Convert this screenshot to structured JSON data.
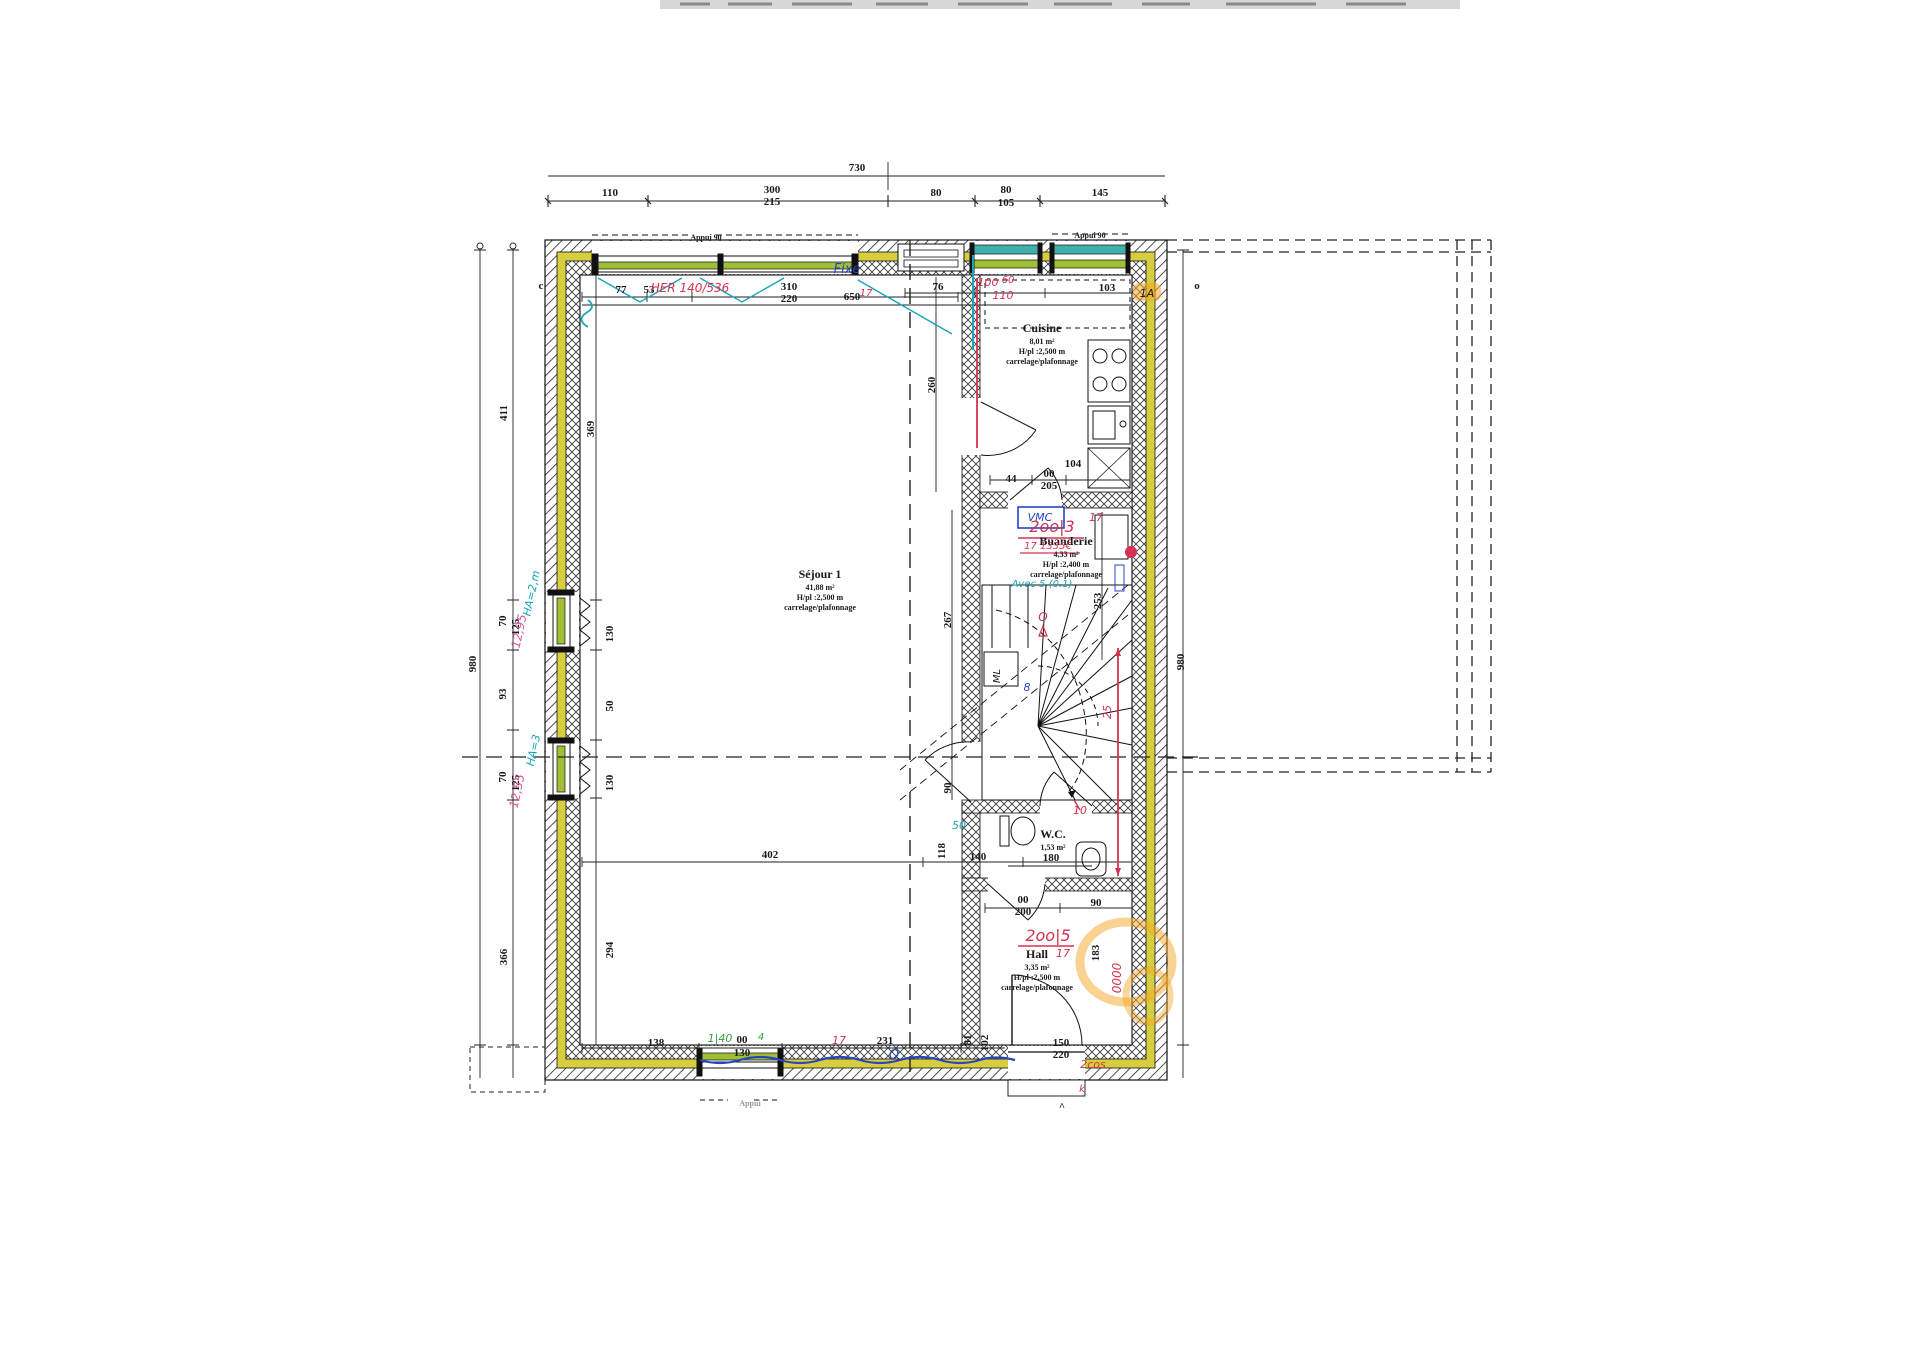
{
  "title": "Plan rez-de-chaussee scanne et annote",
  "rooms": [
    {
      "name": "Séjour 1",
      "area": "41,88 m²",
      "height": "H/pl :2,500 m",
      "finish": "carrelage/plafonnage",
      "x": 820,
      "y": 578
    },
    {
      "name": "Cuisine",
      "area": "8,01 m²",
      "height": "H/pl :2,500 m",
      "finish": "carrelage/plafonnage",
      "x": 1042,
      "y": 332
    },
    {
      "name": "Buanderie",
      "area": "4,33 m²",
      "height": "H/pl :2,400 m",
      "finish": "carrelage/plafonnage",
      "x": 1066,
      "y": 545
    },
    {
      "name": "W.C.",
      "area": "1,53 m²",
      "height": "",
      "finish": "",
      "x": 1053,
      "y": 838
    },
    {
      "name": "Hall",
      "area": "3,35 m²",
      "height": "H/pl :2,500 m",
      "finish": "carrelage/plafonnage",
      "x": 1037,
      "y": 958
    }
  ],
  "dimensions": [
    {
      "t": "730",
      "x": 857,
      "y": 171
    },
    {
      "t": "110",
      "x": 610,
      "y": 196
    },
    {
      "t": "300",
      "x": 772,
      "y": 193
    },
    {
      "t": "215",
      "x": 772,
      "y": 205
    },
    {
      "t": "80",
      "x": 936,
      "y": 196
    },
    {
      "t": "80",
      "x": 1006,
      "y": 193
    },
    {
      "t": "105",
      "x": 1006,
      "y": 206
    },
    {
      "t": "145",
      "x": 1100,
      "y": 196
    },
    {
      "t": "980",
      "x": 476,
      "y": 664,
      "r": -90
    },
    {
      "t": "411",
      "x": 507,
      "y": 413,
      "r": -90
    },
    {
      "t": "70",
      "x": 506,
      "y": 621,
      "r": -90
    },
    {
      "t": "125",
      "x": 519,
      "y": 627,
      "r": -90
    },
    {
      "t": "93",
      "x": 506,
      "y": 694,
      "r": -90
    },
    {
      "t": "70",
      "x": 506,
      "y": 777,
      "r": -90
    },
    {
      "t": "125",
      "x": 519,
      "y": 783,
      "r": -90
    },
    {
      "t": "366",
      "x": 507,
      "y": 957,
      "r": -90
    },
    {
      "t": "980",
      "x": 1184,
      "y": 662,
      "r": -90
    },
    {
      "t": "77",
      "x": 621,
      "y": 293
    },
    {
      "t": "53",
      "x": 649,
      "y": 293
    },
    {
      "t": "310",
      "x": 789,
      "y": 290
    },
    {
      "t": "220",
      "x": 789,
      "y": 302
    },
    {
      "t": "650",
      "x": 852,
      "y": 300
    },
    {
      "t": "76",
      "x": 938,
      "y": 290
    },
    {
      "t": "103",
      "x": 1107,
      "y": 291
    },
    {
      "t": "Appui 90",
      "x": 706,
      "y": 240,
      "s": 8
    },
    {
      "t": "Appui 90",
      "x": 1090,
      "y": 238,
      "s": 8
    },
    {
      "t": "Appui",
      "x": 750,
      "y": 1106,
      "s": 8,
      "c": "gray"
    },
    {
      "t": "369",
      "x": 594,
      "y": 429,
      "r": -90
    },
    {
      "t": "130",
      "x": 613,
      "y": 634,
      "r": -90
    },
    {
      "t": "50",
      "x": 613,
      "y": 706,
      "r": -90
    },
    {
      "t": "130",
      "x": 613,
      "y": 783,
      "r": -90
    },
    {
      "t": "294",
      "x": 613,
      "y": 950,
      "r": -90
    },
    {
      "t": "260",
      "x": 935,
      "y": 385,
      "r": -90
    },
    {
      "t": "267",
      "x": 951,
      "y": 620,
      "r": -90
    },
    {
      "t": "90",
      "x": 951,
      "y": 788,
      "r": -90
    },
    {
      "t": "253",
      "x": 1101,
      "y": 601,
      "r": -90
    },
    {
      "t": "118",
      "x": 945,
      "y": 851,
      "r": -90
    },
    {
      "t": "81",
      "x": 971,
      "y": 1040,
      "r": -90
    },
    {
      "t": "102",
      "x": 988,
      "y": 1043,
      "r": -90
    },
    {
      "t": "183",
      "x": 1099,
      "y": 953,
      "r": -90
    },
    {
      "t": "104",
      "x": 1073,
      "y": 467
    },
    {
      "t": "44",
      "x": 1011,
      "y": 482
    },
    {
      "t": "00",
      "x": 1049,
      "y": 477
    },
    {
      "t": "205",
      "x": 1049,
      "y": 489
    },
    {
      "t": "402",
      "x": 770,
      "y": 858
    },
    {
      "t": "140",
      "x": 978,
      "y": 860
    },
    {
      "t": "180",
      "x": 1051,
      "y": 861
    },
    {
      "t": "90",
      "x": 1096,
      "y": 906
    },
    {
      "t": "00",
      "x": 1023,
      "y": 903
    },
    {
      "t": "200",
      "x": 1023,
      "y": 915
    },
    {
      "t": "150",
      "x": 1061,
      "y": 1046
    },
    {
      "t": "220",
      "x": 1061,
      "y": 1058
    },
    {
      "t": "138",
      "x": 656,
      "y": 1046
    },
    {
      "t": "00",
      "x": 742,
      "y": 1043
    },
    {
      "t": "130",
      "x": 742,
      "y": 1056
    },
    {
      "t": "231",
      "x": 885,
      "y": 1044
    },
    {
      "t": "c",
      "x": 541,
      "y": 289
    },
    {
      "t": "o",
      "x": 1197,
      "y": 289
    },
    {
      "t": "^",
      "x": 1062,
      "y": 1110
    }
  ],
  "annotations": [
    {
      "t": "HER 140/536",
      "x": 690,
      "y": 292,
      "c": "red",
      "s": 12
    },
    {
      "t": "17",
      "x": 866,
      "y": 296,
      "c": "red",
      "s": 10
    },
    {
      "t": "100",
      "x": 988,
      "y": 286,
      "c": "red",
      "s": 11
    },
    {
      "t": "60",
      "x": 1008,
      "y": 283,
      "c": "red",
      "s": 10
    },
    {
      "t": "110",
      "x": 1003,
      "y": 299,
      "c": "red",
      "s": 11
    },
    {
      "t": "25",
      "x": 1111,
      "y": 712,
      "c": "red",
      "s": 11,
      "r": -90
    },
    {
      "t": "2oo|3",
      "x": 1052,
      "y": 532,
      "c": "red",
      "s": 16
    },
    {
      "t": "17",
      "x": 1096,
      "y": 521,
      "c": "red",
      "s": 11
    },
    {
      "t": "17 1335€",
      "x": 1048,
      "y": 549,
      "c": "red",
      "s": 10
    },
    {
      "t": "O",
      "x": 1043,
      "y": 621,
      "c": "red",
      "s": 12
    },
    {
      "t": "10",
      "x": 1080,
      "y": 814,
      "c": "red",
      "s": 11
    },
    {
      "t": "2oo|5",
      "x": 1048,
      "y": 941,
      "c": "red",
      "s": 16
    },
    {
      "t": "17",
      "x": 1063,
      "y": 957,
      "c": "red",
      "s": 11
    },
    {
      "t": "0000",
      "x": 1121,
      "y": 978,
      "c": "red",
      "s": 12,
      "r": -90
    },
    {
      "t": "2cos",
      "x": 1093,
      "y": 1068,
      "c": "red",
      "s": 11
    },
    {
      "t": "17",
      "x": 839,
      "y": 1044,
      "c": "red",
      "s": 11
    },
    {
      "t": "k",
      "x": 1082,
      "y": 1092,
      "c": "red",
      "s": 10
    },
    {
      "t": "12,95",
      "x": 523,
      "y": 632,
      "c": "pink",
      "s": 12,
      "r": -78
    },
    {
      "t": "12,55",
      "x": 521,
      "y": 792,
      "c": "pink",
      "s": 12,
      "r": -78
    },
    {
      "t": "HA=2,m",
      "x": 535,
      "y": 594,
      "c": "teal",
      "s": 11,
      "r": -78
    },
    {
      "t": "HA=3",
      "x": 537,
      "y": 751,
      "c": "teal",
      "s": 11,
      "r": -78
    },
    {
      "t": "Avec 5 (0.1)",
      "x": 1042,
      "y": 587,
      "c": "teal",
      "s": 10
    },
    {
      "t": "50",
      "x": 959,
      "y": 829,
      "c": "teal",
      "s": 11
    },
    {
      "t": "Fixe",
      "x": 847,
      "y": 273,
      "c": "blue",
      "s": 13
    },
    {
      "t": "O",
      "x": 894,
      "y": 1059,
      "c": "blue",
      "s": 13
    },
    {
      "t": "8",
      "x": 1027,
      "y": 691,
      "c": "blue",
      "s": 11
    },
    {
      "t": "VMC",
      "x": 1040,
      "y": 521,
      "c": "blue",
      "s": 11
    },
    {
      "t": "1|40",
      "x": 720,
      "y": 1042,
      "c": "green",
      "s": 11
    },
    {
      "t": "4",
      "x": 761,
      "y": 1040,
      "c": "green",
      "s": 10
    },
    {
      "t": "1A",
      "x": 1147,
      "y": 297,
      "c": "dark",
      "s": 11
    },
    {
      "t": "ML",
      "x": 1000,
      "y": 676,
      "c": "dark",
      "s": 10,
      "r": -90
    }
  ],
  "colors": {
    "wall_yellow": "#d6ce3e",
    "window_teal": "#3fb0ac",
    "window_green": "#9fbf36",
    "hand_red": "#d23352",
    "hand_pink": "#e0559a",
    "hand_blue": "#2546c0",
    "hand_teal": "#18a5b5",
    "hand_green": "#2f9e44",
    "highlight_orange": "#f5a623",
    "gray": "#999999",
    "dark": "#1a1a1a"
  }
}
